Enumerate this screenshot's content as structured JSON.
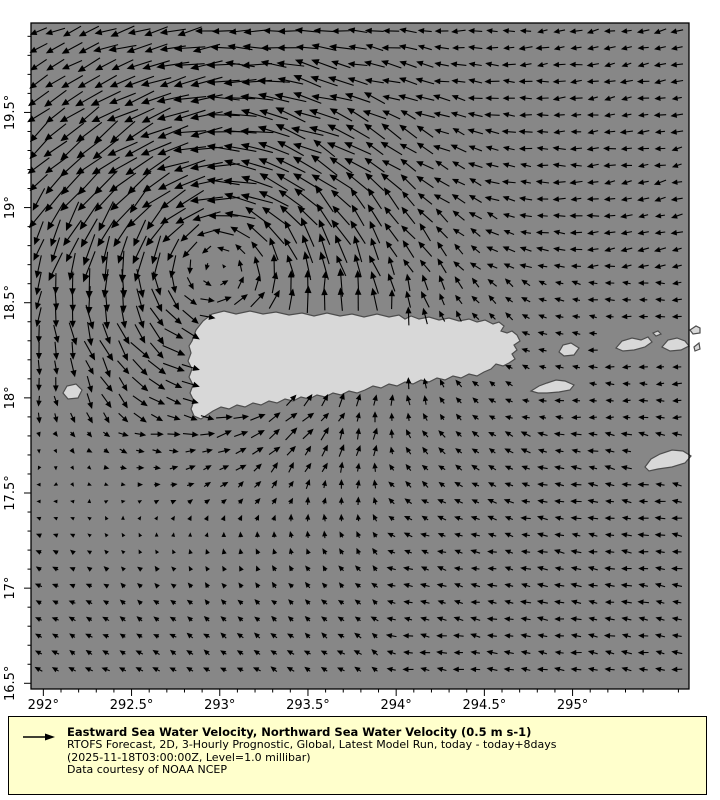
{
  "map": {
    "frame": {
      "left": 31,
      "top": 23,
      "width": 658,
      "height": 666
    },
    "lon_min": 291.93,
    "lon_max": 295.66,
    "lat_min": 16.47,
    "lat_max": 19.97,
    "ocean_color": "#878787",
    "land_color": "#d8d8d8",
    "coast_color": "#4d4d4d",
    "arrow_color": "#000000",
    "frame_color": "#000000",
    "x_ticks": {
      "lons": [
        292,
        292.5,
        293,
        293.5,
        294,
        294.5,
        295
      ],
      "labels": [
        "292°",
        "292.5°",
        "293°",
        "293.5°",
        "294°",
        "294.5°",
        "295°"
      ]
    },
    "y_ticks": {
      "lats": [
        16.5,
        17,
        17.5,
        18,
        18.5,
        19,
        19.5
      ],
      "labels": [
        "16.5°",
        "17°",
        "17.5°",
        "18°",
        "18.5°",
        "19°",
        "19.5°"
      ]
    },
    "minor_step": 0.1,
    "tick_label_size": 13
  },
  "islands": [
    {
      "name": "puerto-rico",
      "mask_pad": 0,
      "points": [
        [
          192,
          341
        ],
        [
          196,
          330
        ],
        [
          203,
          321
        ],
        [
          212,
          314
        ],
        [
          224,
          311
        ],
        [
          236,
          314
        ],
        [
          250,
          311
        ],
        [
          263,
          314
        ],
        [
          276,
          312
        ],
        [
          289,
          315
        ],
        [
          302,
          313
        ],
        [
          314,
          316
        ],
        [
          327,
          313
        ],
        [
          340,
          316
        ],
        [
          352,
          314
        ],
        [
          364,
          317
        ],
        [
          377,
          314
        ],
        [
          389,
          317
        ],
        [
          399,
          315
        ],
        [
          405,
          319
        ],
        [
          411,
          316
        ],
        [
          419,
          319
        ],
        [
          429,
          317
        ],
        [
          439,
          320
        ],
        [
          449,
          318
        ],
        [
          459,
          321
        ],
        [
          469,
          319
        ],
        [
          477,
          322
        ],
        [
          485,
          320
        ],
        [
          493,
          324
        ],
        [
          499,
          322
        ],
        [
          504,
          326
        ],
        [
          501,
          331
        ],
        [
          507,
          333
        ],
        [
          512,
          331
        ],
        [
          517,
          335
        ],
        [
          520,
          341
        ],
        [
          514,
          345
        ],
        [
          517,
          350
        ],
        [
          512,
          354
        ],
        [
          515,
          359
        ],
        [
          509,
          363
        ],
        [
          503,
          366
        ],
        [
          496,
          364
        ],
        [
          491,
          369
        ],
        [
          484,
          372
        ],
        [
          477,
          376
        ],
        [
          469,
          374
        ],
        [
          461,
          378
        ],
        [
          453,
          376
        ],
        [
          445,
          380
        ],
        [
          437,
          378
        ],
        [
          429,
          382
        ],
        [
          421,
          380
        ],
        [
          413,
          384
        ],
        [
          405,
          382
        ],
        [
          397,
          386
        ],
        [
          389,
          384
        ],
        [
          381,
          388
        ],
        [
          373,
          386
        ],
        [
          365,
          390
        ],
        [
          357,
          393
        ],
        [
          349,
          391
        ],
        [
          341,
          395
        ],
        [
          333,
          393
        ],
        [
          325,
          397
        ],
        [
          317,
          395
        ],
        [
          309,
          399
        ],
        [
          301,
          397
        ],
        [
          293,
          401
        ],
        [
          285,
          399
        ],
        [
          277,
          403
        ],
        [
          269,
          401
        ],
        [
          261,
          405
        ],
        [
          253,
          403
        ],
        [
          245,
          407
        ],
        [
          237,
          405
        ],
        [
          229,
          409
        ],
        [
          221,
          407
        ],
        [
          213,
          411
        ],
        [
          207,
          415
        ],
        [
          201,
          419
        ],
        [
          194,
          416
        ],
        [
          191,
          409
        ],
        [
          194,
          401
        ],
        [
          190,
          393
        ],
        [
          193,
          385
        ],
        [
          189,
          377
        ],
        [
          192,
          369
        ],
        [
          188,
          361
        ],
        [
          191,
          353
        ],
        [
          189,
          346
        ]
      ]
    },
    {
      "name": "mona",
      "mask_pad": 4,
      "points": [
        [
          63,
          393
        ],
        [
          67,
          386
        ],
        [
          76,
          384
        ],
        [
          82,
          390
        ],
        [
          78,
          398
        ],
        [
          68,
          399
        ]
      ]
    },
    {
      "name": "vieques",
      "mask_pad": 7,
      "points": [
        [
          531,
          391
        ],
        [
          539,
          386
        ],
        [
          547,
          383
        ],
        [
          556,
          380
        ],
        [
          565,
          381
        ],
        [
          574,
          385
        ],
        [
          570,
          390
        ],
        [
          559,
          392
        ],
        [
          547,
          393
        ],
        [
          538,
          393
        ]
      ]
    },
    {
      "name": "culebra",
      "mask_pad": 7,
      "points": [
        [
          559,
          352
        ],
        [
          563,
          345
        ],
        [
          571,
          343
        ],
        [
          579,
          348
        ],
        [
          574,
          355
        ],
        [
          564,
          356
        ]
      ]
    },
    {
      "name": "st-thomas",
      "mask_pad": 7,
      "points": [
        [
          616,
          348
        ],
        [
          622,
          341
        ],
        [
          632,
          338
        ],
        [
          641,
          340
        ],
        [
          648,
          337
        ],
        [
          652,
          342
        ],
        [
          645,
          347
        ],
        [
          634,
          350
        ],
        [
          623,
          351
        ]
      ]
    },
    {
      "name": "tortola",
      "mask_pad": 7,
      "points": [
        [
          662,
          347
        ],
        [
          668,
          340
        ],
        [
          677,
          338
        ],
        [
          685,
          341
        ],
        [
          689,
          346
        ],
        [
          681,
          350
        ],
        [
          670,
          351
        ]
      ]
    },
    {
      "name": "cay-1",
      "mask_pad": 5,
      "points": [
        [
          653,
          333
        ],
        [
          658,
          331
        ],
        [
          661,
          334
        ],
        [
          656,
          336
        ]
      ]
    },
    {
      "name": "cay-2",
      "mask_pad": 5,
      "points": [
        [
          690,
          330
        ],
        [
          696,
          326
        ],
        [
          700,
          328
        ],
        [
          700,
          333
        ],
        [
          693,
          334
        ]
      ]
    },
    {
      "name": "right-edge-islet",
      "mask_pad": 5,
      "points": [
        [
          694,
          347
        ],
        [
          699,
          343
        ],
        [
          700,
          349
        ],
        [
          695,
          351
        ]
      ]
    },
    {
      "name": "st-croix",
      "mask_pad": 6,
      "points": [
        [
          645,
          467
        ],
        [
          651,
          459
        ],
        [
          660,
          454
        ],
        [
          672,
          450
        ],
        [
          683,
          451
        ],
        [
          691,
          456
        ],
        [
          685,
          463
        ],
        [
          672,
          467
        ],
        [
          658,
          469
        ],
        [
          649,
          471
        ]
      ]
    }
  ],
  "vector_field": {
    "grid": {
      "x0": 39,
      "y0": 31,
      "step": 16.8,
      "cols": 39,
      "rows": 40
    },
    "vortex": {
      "x": 215,
      "y": 250,
      "sigma": 135,
      "strength": 26,
      "falloff_power": 1.5
    },
    "base": {
      "atlantic": {
        "y_max": 270,
        "u": -10,
        "v": 2.5
      },
      "mid": {
        "u": -8,
        "v": 0.5
      },
      "caribbean": {
        "y_min": 430,
        "split_x": 380,
        "west": {
          "u": -6.5,
          "v": -3.5
        },
        "east": {
          "u": -9,
          "v": -1.2
        }
      }
    },
    "length_min": 2.5,
    "length_max": 32,
    "jitter": {
      "seed": 42,
      "angle": 0.18,
      "scale": 0.15
    },
    "head": {
      "base": 3.2,
      "rate": 0.1,
      "max": 6.5
    },
    "stroke_width": 1.1
  },
  "legend": {
    "bg_color": "#ffffcc",
    "arrow_color": "#000000",
    "title": "Eastward Sea Water Velocity, Northward Sea Water Velocity (0.5 m s-1)",
    "line2": "RTOFS Forecast, 2D, 3-Hourly Prognostic, Global, Latest Model Run, today - today+8days",
    "line3": "(2025-11-18T03:00:00Z, Level=1.0 millibar)",
    "line4": "Data courtesy of NOAA NCEP"
  }
}
